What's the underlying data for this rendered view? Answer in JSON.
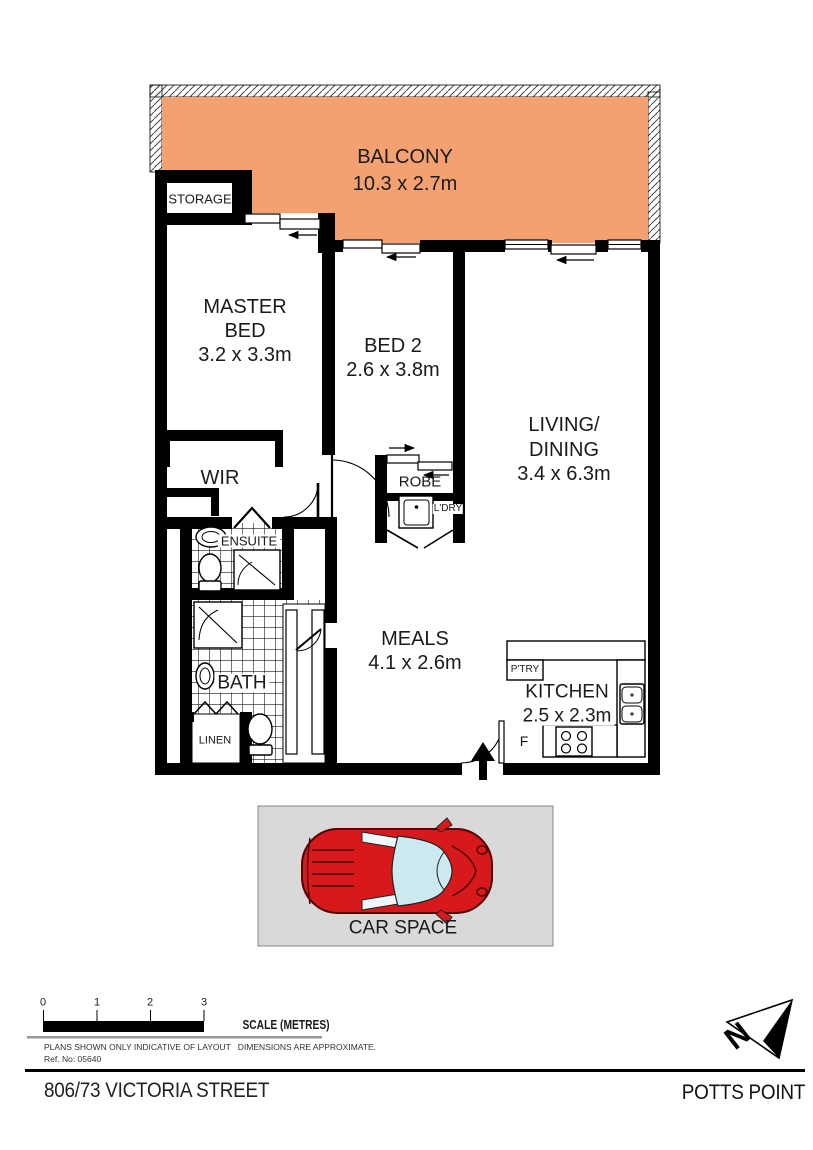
{
  "rooms": {
    "balcony": {
      "name": "BALCONY",
      "dims": "10.3 x 2.7m"
    },
    "storage": {
      "name": "STORAGE"
    },
    "master_bed": {
      "line1": "MASTER",
      "line2": "BED",
      "dims": "3.2 x 3.3m"
    },
    "bed2": {
      "name": "BED 2",
      "dims": "2.6 x 3.8m"
    },
    "living_dining": {
      "line1": "LIVING/",
      "line2": "DINING",
      "dims": "3.4 x 6.3m"
    },
    "wir": {
      "name": "WIR"
    },
    "ensuite": {
      "name": "ENSUITE"
    },
    "bath": {
      "name": "BATH"
    },
    "linen": {
      "name": "LINEN"
    },
    "robe": {
      "name": "ROBE"
    },
    "laundry": {
      "name": "L'DRY"
    },
    "meals": {
      "name": "MEALS",
      "dims": "4.1 x 2.6m"
    },
    "pantry": {
      "name": "P'TRY"
    },
    "kitchen": {
      "name": "KITCHEN",
      "dims": "2.5 x 2.3m"
    },
    "fridge": {
      "name": "F"
    },
    "car_space": {
      "name": "CAR SPACE"
    }
  },
  "compass": {
    "north": "N"
  },
  "scale_bar": {
    "ticks": [
      "0",
      "1",
      "2",
      "3"
    ],
    "label": "SCALE (METRES)"
  },
  "notes": {
    "line1": "PLANS SHOWN ONLY INDICATIVE OF LAYOUT   DIMENSIONS ARE APPROXIMATE.",
    "line2": "Ref. No: 05640"
  },
  "footer": {
    "address": "806/73 VICTORIA STREET",
    "suburb": "POTTS POINT"
  },
  "colors": {
    "balcony": "#F4A172",
    "car_body": "#D8191C",
    "car_glass": "#CDE9F0",
    "car_space_bg": "#D9D9D9",
    "wall": "#000000"
  }
}
